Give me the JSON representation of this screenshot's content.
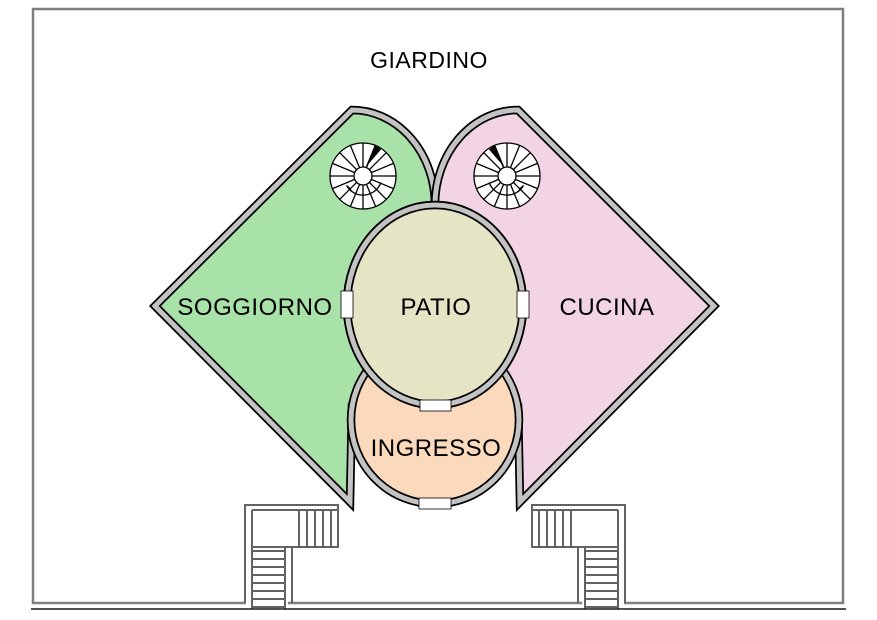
{
  "plan": {
    "title": "GIARDINO",
    "rooms": {
      "soggiorno": {
        "label": "SOGGIORNO",
        "color": "#a9e2a9"
      },
      "cucina": {
        "label": "CUCINA",
        "color": "#f3d4e5"
      },
      "patio": {
        "label": "PATIO",
        "color": "#e5e5c5"
      },
      "ingresso": {
        "label": "INGRESSO",
        "color": "#fad9bc"
      }
    },
    "colors": {
      "wall": "#c3c3c3",
      "frame": "#7f7f7f",
      "bottom_stairs": "#636363",
      "ground_line": "#1a1a1a"
    }
  }
}
